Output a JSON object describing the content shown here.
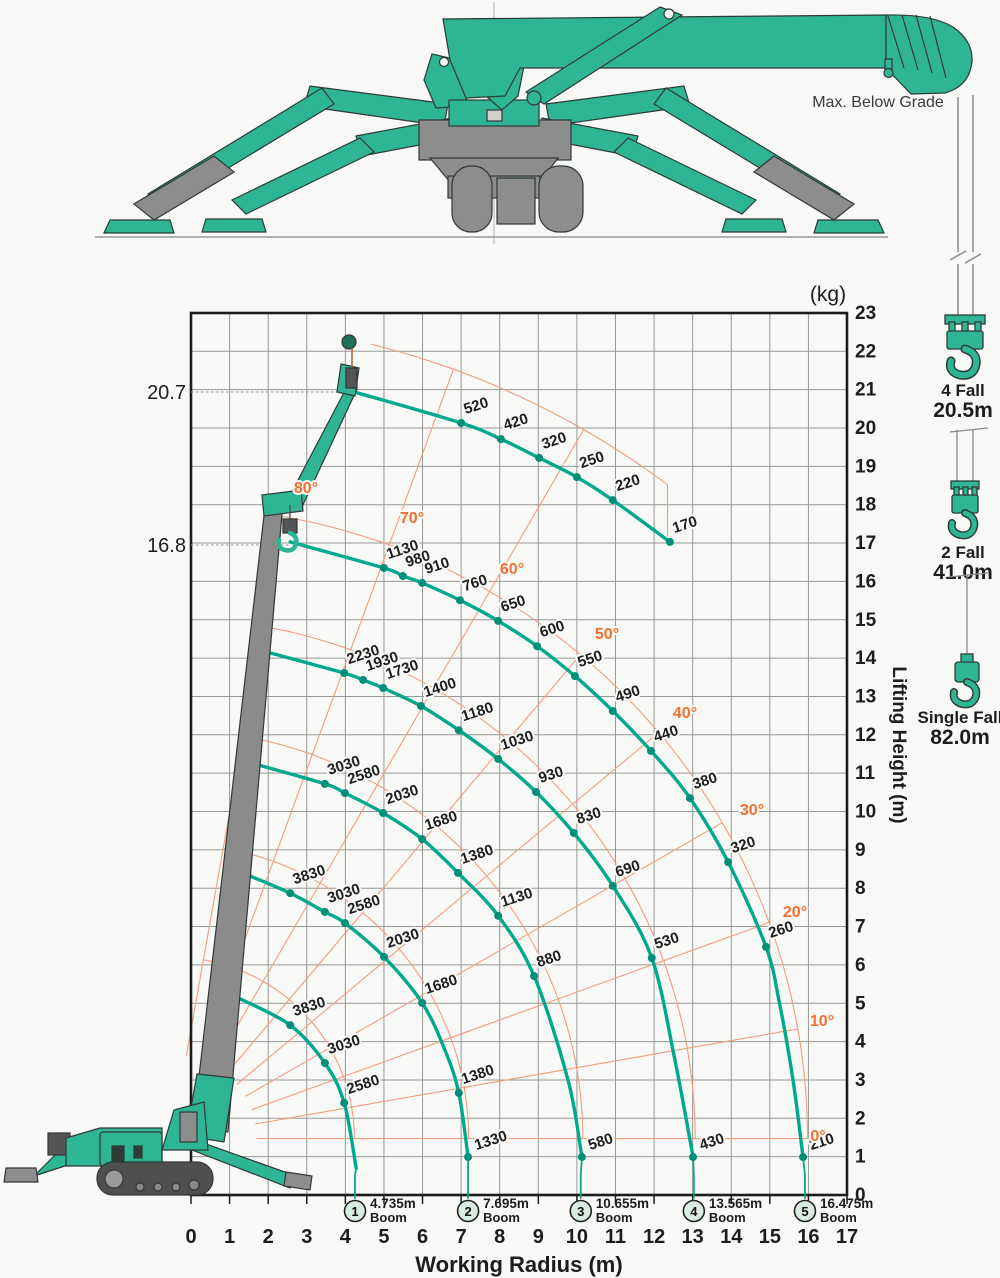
{
  "annotations": {
    "max_below_grade": "Max. Below Grade",
    "unit": "(kg)"
  },
  "hook_annotations": [
    {
      "falls": "4 Fall",
      "length": "20.5m"
    },
    {
      "falls": "2 Fall",
      "length": "41.0m"
    },
    {
      "falls": "Single Fall",
      "length": "82.0m"
    }
  ],
  "chart_data": {
    "type": "line",
    "title": "Crane working range and rated load chart",
    "xlabel": "Working Radius (m)",
    "ylabel": "Lifting Height (m)",
    "xlim": [
      0,
      17
    ],
    "ylim": [
      0,
      23
    ],
    "grid": true,
    "pivot": {
      "r": -0.5,
      "h": 1.47
    },
    "boom_lengths_m": [
      4.735,
      7.695,
      10.655,
      13.565,
      16.475
    ],
    "jib_radius_m": 21.35,
    "jib_arc_range_deg": [
      53,
      76
    ],
    "angle_lines": {
      "angles_deg": [
        0,
        10,
        20,
        30,
        40,
        50,
        60,
        70,
        80
      ],
      "labels": [
        {
          "text": "0°",
          "x": 818,
          "y": 1141
        },
        {
          "text": "10°",
          "x": 822,
          "y": 1026
        },
        {
          "text": "20°",
          "x": 795,
          "y": 917
        },
        {
          "text": "30°",
          "x": 752,
          "y": 815
        },
        {
          "text": "40°",
          "x": 685,
          "y": 718
        },
        {
          "text": "50°",
          "x": 607,
          "y": 639
        },
        {
          "text": "60°",
          "x": 512,
          "y": 574
        },
        {
          "text": "70°",
          "x": 412,
          "y": 523
        },
        {
          "text": "80°",
          "x": 306,
          "y": 493
        }
      ]
    },
    "height_markers": [
      {
        "value": "20.7",
        "y_px": 392,
        "x_end_px": 352
      },
      {
        "value": "16.8",
        "y_px": 545,
        "x_end_px": 291
      }
    ],
    "curves": [
      {
        "id": "jib-max-height",
        "marker": null,
        "marker_r": null,
        "points": [
          [
            4.17,
            20.96,
            null
          ],
          [
            7.0,
            20.13,
            "520"
          ],
          [
            8.03,
            19.71,
            "420"
          ],
          [
            9.02,
            19.22,
            "320"
          ],
          [
            10.0,
            18.72,
            "250"
          ],
          [
            10.93,
            18.12,
            "220"
          ],
          [
            12.41,
            17.03,
            "170"
          ]
        ]
      },
      {
        "id": "boom5",
        "marker": "5",
        "marker_r": 15.91,
        "points": [
          [
            2.57,
            17.03,
            null
          ],
          [
            5.0,
            16.35,
            "1130"
          ],
          [
            5.49,
            16.14,
            "980"
          ],
          [
            5.99,
            15.96,
            "910"
          ],
          [
            6.97,
            15.51,
            "760"
          ],
          [
            7.96,
            14.97,
            "650"
          ],
          [
            8.97,
            14.31,
            "600"
          ],
          [
            9.95,
            13.53,
            "550"
          ],
          [
            10.93,
            12.62,
            "490"
          ],
          [
            11.92,
            11.58,
            "440"
          ],
          [
            12.93,
            10.35,
            "380"
          ],
          [
            13.92,
            8.68,
            "320"
          ],
          [
            14.9,
            6.47,
            "260"
          ],
          [
            15.25,
            5.0,
            null
          ],
          [
            15.6,
            3.0,
            null
          ],
          [
            15.86,
            0.99,
            "210"
          ]
        ]
      },
      {
        "id": "boom4",
        "marker": "4",
        "marker_r": 13.03,
        "points": [
          [
            2.07,
            14.13,
            null
          ],
          [
            3.97,
            13.61,
            "2230"
          ],
          [
            4.46,
            13.43,
            "1930"
          ],
          [
            4.98,
            13.22,
            "1730"
          ],
          [
            5.96,
            12.75,
            "1400"
          ],
          [
            6.94,
            12.12,
            "1180"
          ],
          [
            7.96,
            11.37,
            "1030"
          ],
          [
            8.94,
            10.51,
            "930"
          ],
          [
            9.92,
            9.44,
            "830"
          ],
          [
            10.93,
            8.06,
            "690"
          ],
          [
            11.94,
            6.18,
            "530"
          ],
          [
            12.54,
            3.52,
            null
          ],
          [
            13.01,
            0.99,
            "430"
          ]
        ]
      },
      {
        "id": "boom3",
        "marker": "3",
        "marker_r": 10.1,
        "points": [
          [
            1.58,
            11.26,
            null
          ],
          [
            3.47,
            10.72,
            "3030"
          ],
          [
            3.99,
            10.48,
            "2580"
          ],
          [
            4.98,
            9.96,
            "2030"
          ],
          [
            5.99,
            9.28,
            "1680"
          ],
          [
            6.92,
            8.4,
            "1380"
          ],
          [
            7.96,
            7.28,
            "1130"
          ],
          [
            8.89,
            5.71,
            "880"
          ],
          [
            9.77,
            3.0,
            null
          ],
          [
            10.13,
            0.99,
            "580"
          ]
        ]
      },
      {
        "id": "boom2",
        "marker": "2",
        "marker_r": 7.18,
        "points": [
          [
            1.48,
            8.34,
            null
          ],
          [
            2.57,
            7.87,
            "3830"
          ],
          [
            3.47,
            7.38,
            "3030"
          ],
          [
            3.99,
            7.09,
            "2580"
          ],
          [
            5.0,
            6.21,
            "2030"
          ],
          [
            5.99,
            5.01,
            "1680"
          ],
          [
            6.58,
            3.78,
            null
          ],
          [
            6.94,
            2.66,
            "1380"
          ],
          [
            7.18,
            0.99,
            "1330"
          ]
        ]
      },
      {
        "id": "boom1",
        "marker": "1",
        "marker_r": 4.25,
        "points": [
          [
            1.22,
            5.14,
            null
          ],
          [
            2.57,
            4.43,
            "3830"
          ],
          [
            3.47,
            3.44,
            "3030"
          ],
          [
            3.97,
            2.4,
            "2580"
          ],
          [
            4.28,
            0.7,
            null
          ]
        ]
      }
    ],
    "boom_markers": [
      {
        "num": "1",
        "length": "4.735m",
        "word": "Boom",
        "r": 4.25
      },
      {
        "num": "2",
        "length": "7.695m",
        "word": "Boom",
        "r": 7.18
      },
      {
        "num": "3",
        "length": "10.655m",
        "word": "Boom",
        "r": 10.1
      },
      {
        "num": "4",
        "length": "13.565m",
        "word": "Boom",
        "r": 13.03
      },
      {
        "num": "5",
        "length": "16.475m",
        "word": "Boom",
        "r": 15.91
      }
    ],
    "colors": {
      "curve": "#00a98c",
      "dot": "#008f76",
      "orange_line": "#f29e7e",
      "orange_text": "#f2702e",
      "grid": "#979797",
      "border": "#1c1c1c",
      "text": "#1d1d1d",
      "marker_fill": "#d9ece2",
      "crane_green": "#2eb593",
      "machine_gray": "#8d8d8d"
    }
  }
}
